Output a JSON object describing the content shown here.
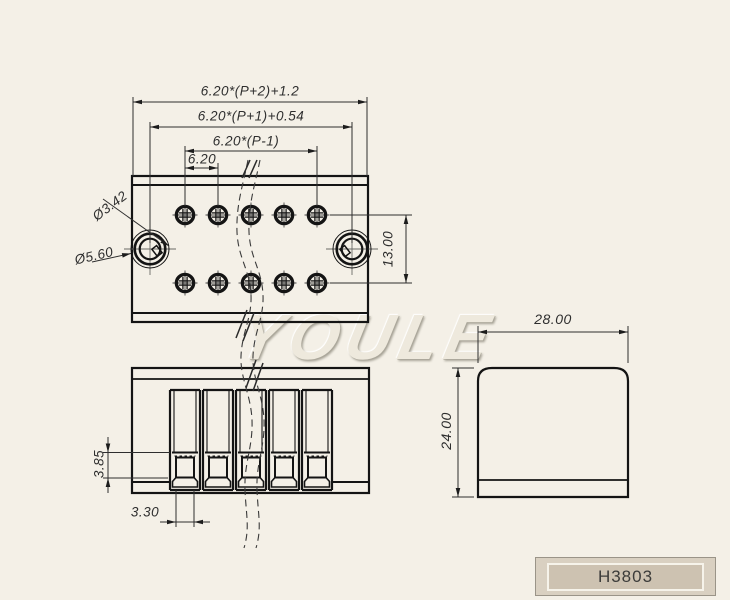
{
  "drawing": {
    "part_number": "H3803",
    "watermark": "YOULE",
    "colors": {
      "background": "#f4f0e7",
      "object_line": "#141414",
      "dimension_line": "#2e2e2e",
      "title_fill": "#cdc2b1",
      "title_frame": "#d9d0c1"
    },
    "top_view": {
      "dims": {
        "overall_width": "6.20*(P+2)+1.2",
        "mount_hole_span": "6.20*(P+1)+0.54",
        "pole_span": "6.20*(P-1)",
        "pitch": "6.20",
        "row_spacing": "13.00",
        "inner_hole_dia": "Ø3.42",
        "outer_hole_dia": "Ø5.60"
      }
    },
    "front_view": {
      "dims": {
        "window_height": "3.85",
        "window_width": "3.30"
      }
    },
    "side_view": {
      "dims": {
        "depth": "28.00",
        "height": "24.00"
      }
    }
  }
}
